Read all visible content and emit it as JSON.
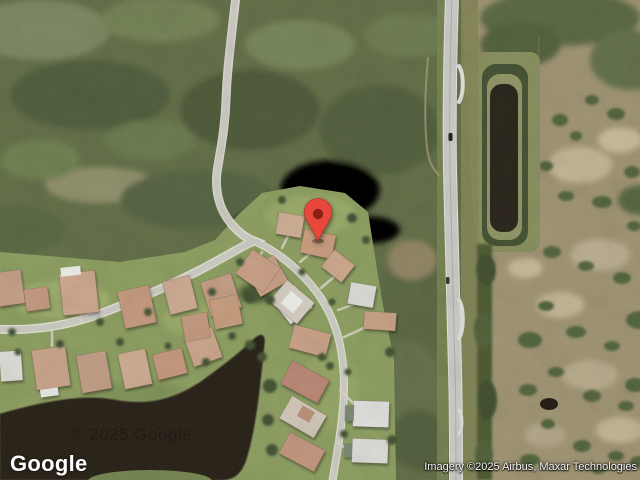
{
  "branding": {
    "logo_text": "Google"
  },
  "attribution": {
    "text": "Imagery ©2025 Airbus, Maxar Technologies"
  },
  "watermark": {
    "text": "© 2025 Google"
  },
  "marker": {
    "label": "dropped-pin",
    "color": "#e8473c",
    "inner_color": "#8c1f16"
  },
  "scene": {
    "description": "Satellite view of a residential neighborhood with a lake, bordered by dense scrub forest and a north-south highway with a retention pond"
  }
}
